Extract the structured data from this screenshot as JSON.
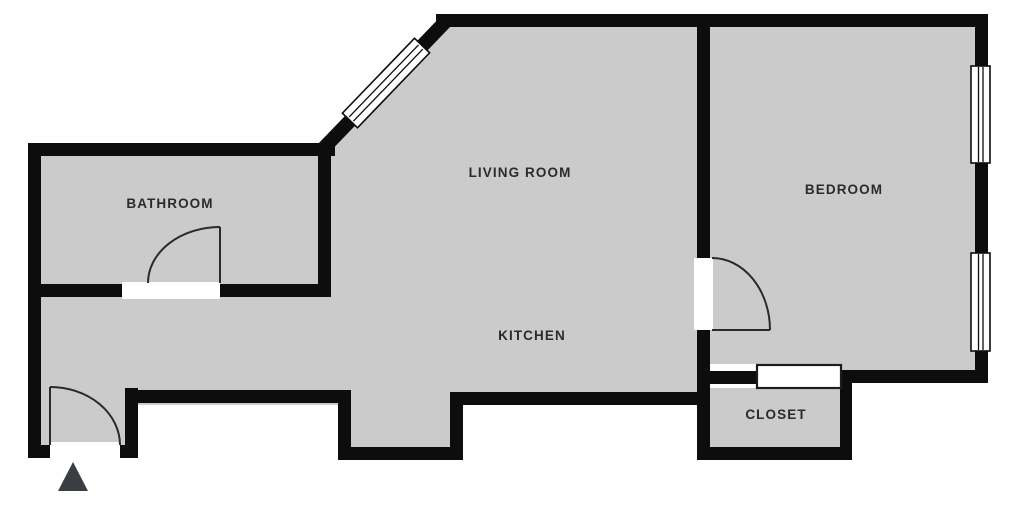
{
  "plan": {
    "rooms": [
      {
        "label": "BATHROOM"
      },
      {
        "label": "LIVING ROOM"
      },
      {
        "label": "KITCHEN"
      },
      {
        "label": "BEDROOM"
      },
      {
        "label": "CLOSET"
      }
    ],
    "features": {
      "doors": [
        "entry-door",
        "bathroom-door",
        "bedroom-door",
        "closet-sliding-door"
      ],
      "windows": [
        "living-room-diagonal-window",
        "bedroom-window-upper",
        "bedroom-window-lower"
      ],
      "entrance_marker": "up-triangle"
    },
    "colors": {
      "background": "#ffffff",
      "floor": "#cbcbcb",
      "wall": "#0d0d0d",
      "opening": "#ffffff",
      "door_swing": "#2a2a2a",
      "label_text": "#2b2b2b",
      "entrance_marker": "#3a3d41"
    }
  }
}
